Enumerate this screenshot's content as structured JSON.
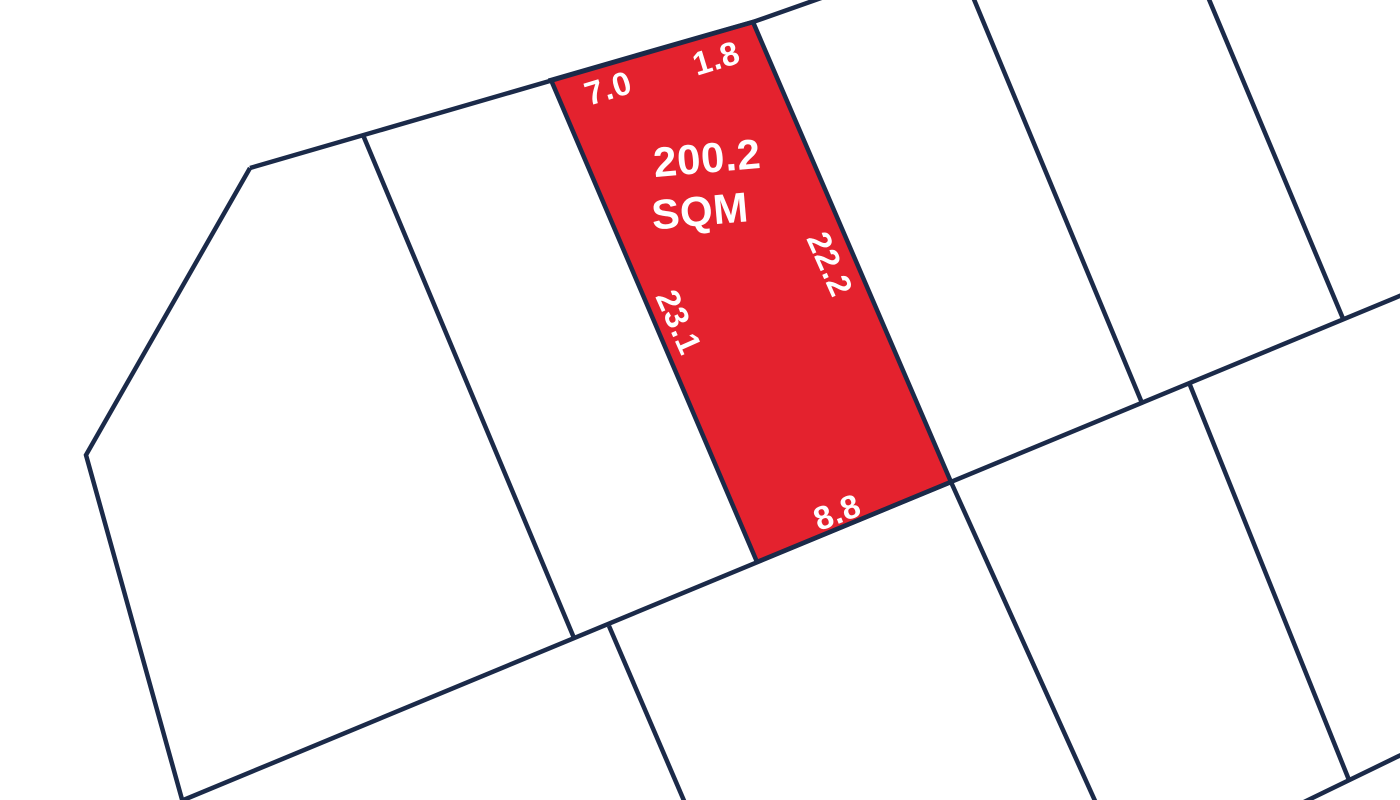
{
  "plan": {
    "background": "#ffffff",
    "line_color": "#1b2a49",
    "line_width": 4.5,
    "label_color": "#ffffff",
    "highlighted_lot": {
      "area_value": "200.2",
      "area_unit": "SQM",
      "side_lengths": {
        "top_west": "7.0",
        "top_east": "1.8",
        "east": "22.2",
        "west": "23.1",
        "south": "8.8"
      },
      "fill": "#e4222e",
      "points": "551,80 707,35 753,22 951,482 757,562"
    },
    "boundaries": [
      {
        "name": "north-boundary-line",
        "points": "250,168 753,22 824,-3"
      },
      {
        "name": "main-road-boundary-line",
        "points": "181,801 1402,295"
      },
      {
        "name": "west-boundary-line",
        "points": "250,168 86,455 183,803"
      },
      {
        "name": "divider-lot1-lot2",
        "points": "363,135 574,638"
      },
      {
        "name": "divider-lot3-lot4",
        "points": "973,-3 1142,403"
      },
      {
        "name": "divider-lot4-lot5",
        "points": "1208,-3 1344,321"
      },
      {
        "name": "bottom-row-divider-west",
        "points": "609,626 685,803"
      },
      {
        "name": "bottom-row-divider-middle",
        "points": "951,482 1096,803"
      },
      {
        "name": "bottom-row-divider-east",
        "points": "1190,385 1349,780"
      },
      {
        "name": "southeast-road-boundary-line",
        "points": "1302,803 1403,754"
      }
    ],
    "labels": [
      {
        "name": "dimension-label-top-west",
        "text": "7.0",
        "x": 608,
        "y": 88,
        "rotate": -17,
        "size": 33
      },
      {
        "name": "dimension-label-top-east",
        "text": "1.8",
        "x": 716,
        "y": 58,
        "rotate": -17,
        "size": 33
      },
      {
        "name": "area-value-label",
        "text": "200.2",
        "x": 707,
        "y": 158,
        "rotate": -5,
        "size": 42
      },
      {
        "name": "area-unit-label",
        "text": "SQM",
        "x": 700,
        "y": 211,
        "rotate": -5,
        "size": 42
      },
      {
        "name": "dimension-label-east",
        "text": "22.2",
        "x": 830,
        "y": 264,
        "rotate": 66,
        "size": 33
      },
      {
        "name": "dimension-label-west",
        "text": "23.1",
        "x": 679,
        "y": 322,
        "rotate": 66,
        "size": 33
      },
      {
        "name": "dimension-label-south",
        "text": "8.8",
        "x": 837,
        "y": 512,
        "rotate": -21,
        "size": 33
      }
    ]
  }
}
